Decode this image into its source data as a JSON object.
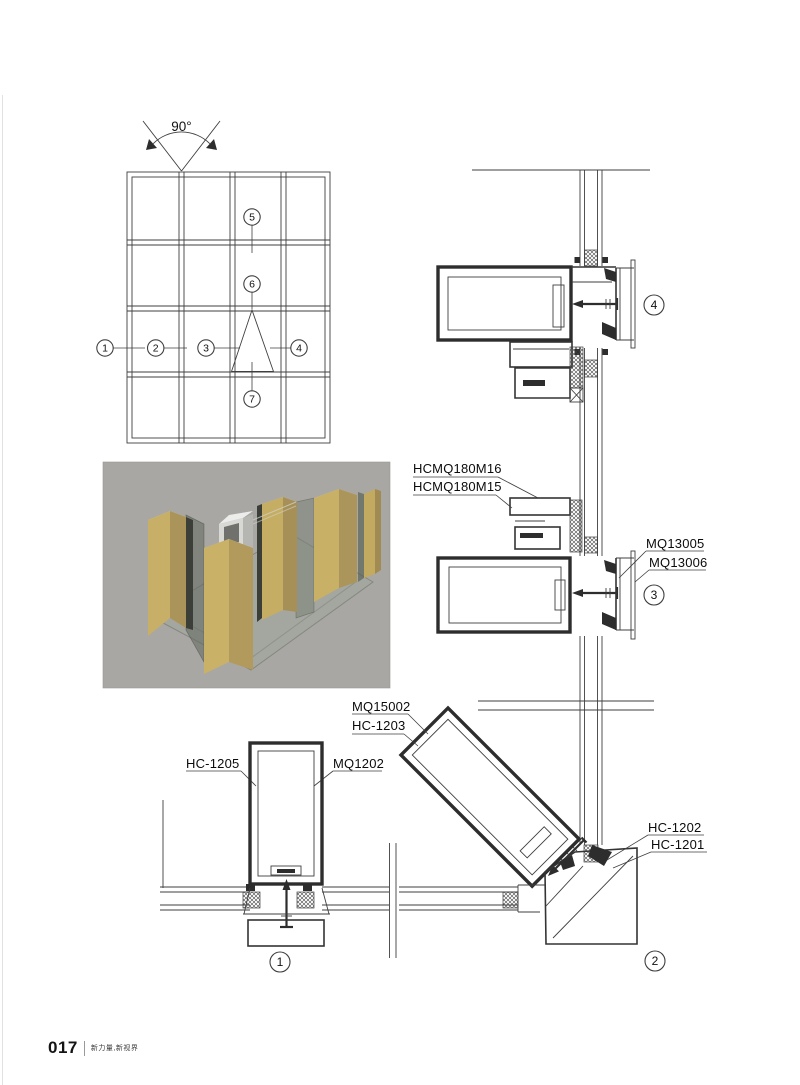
{
  "page": {
    "number": "017",
    "tagline": "新力量,新视界"
  },
  "elevation": {
    "angle_label": "90°",
    "callouts": [
      "1",
      "2",
      "3",
      "4",
      "5",
      "6",
      "7"
    ]
  },
  "detail_callouts": {
    "d1": "1",
    "d2": "2",
    "d3": "3",
    "d4": "4"
  },
  "profile_labels": {
    "hcmq180m16": "HCMQ180M16",
    "hcmq180m15": "HCMQ180M15",
    "mq13005": "MQ13005",
    "mq13006": "MQ13006",
    "mq15002": "MQ15002",
    "hc_1203": "HC-1203",
    "hc_1205": "HC-1205",
    "mq1202": "MQ1202",
    "hc_1202": "HC-1202",
    "hc_1201": "HC-1201"
  },
  "colors": {
    "line": "#3f3f3f",
    "render_background": "#a9a7a3",
    "profile_gold": "#c9b168",
    "profile_gold_shade": "#ab945a",
    "glass_tint": "#9ea89a",
    "page_background": "#ffffff"
  }
}
